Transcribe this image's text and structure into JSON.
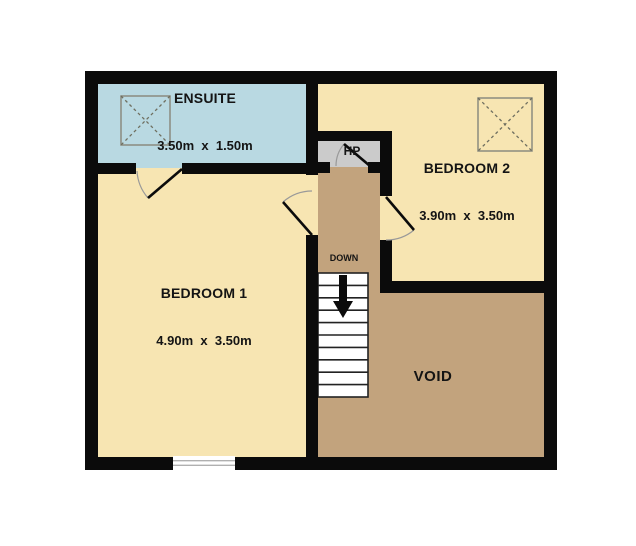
{
  "plan": {
    "rooms": {
      "ensuite": {
        "name": "ENSUITE",
        "dims": "3.50m  x  1.50m"
      },
      "bedroom1": {
        "name": "BEDROOM 1",
        "dims": "4.90m  x  3.50m"
      },
      "bedroom2": {
        "name": "BEDROOM 2",
        "dims": "3.90m  x  3.50m"
      },
      "void": {
        "name": "VOID"
      },
      "hp": {
        "name": "HP"
      }
    },
    "stairs": {
      "label": "DOWN"
    }
  },
  "colors": {
    "wall": "#0b0b0b",
    "ensuite": "#b9d9e2",
    "bedroom": "#f7e5b2",
    "landing": "#c2a37d",
    "hp_closet": "#cbcbcb",
    "stairs_fill": "#ffffff",
    "stairs_line": "#222222",
    "door_arc": "#999999",
    "door_leaf": "#0b0b0b",
    "skylight_outline": "#8b8b7f",
    "skylight_cross": "#6f6f60",
    "window_line": "#b0b0b0"
  }
}
